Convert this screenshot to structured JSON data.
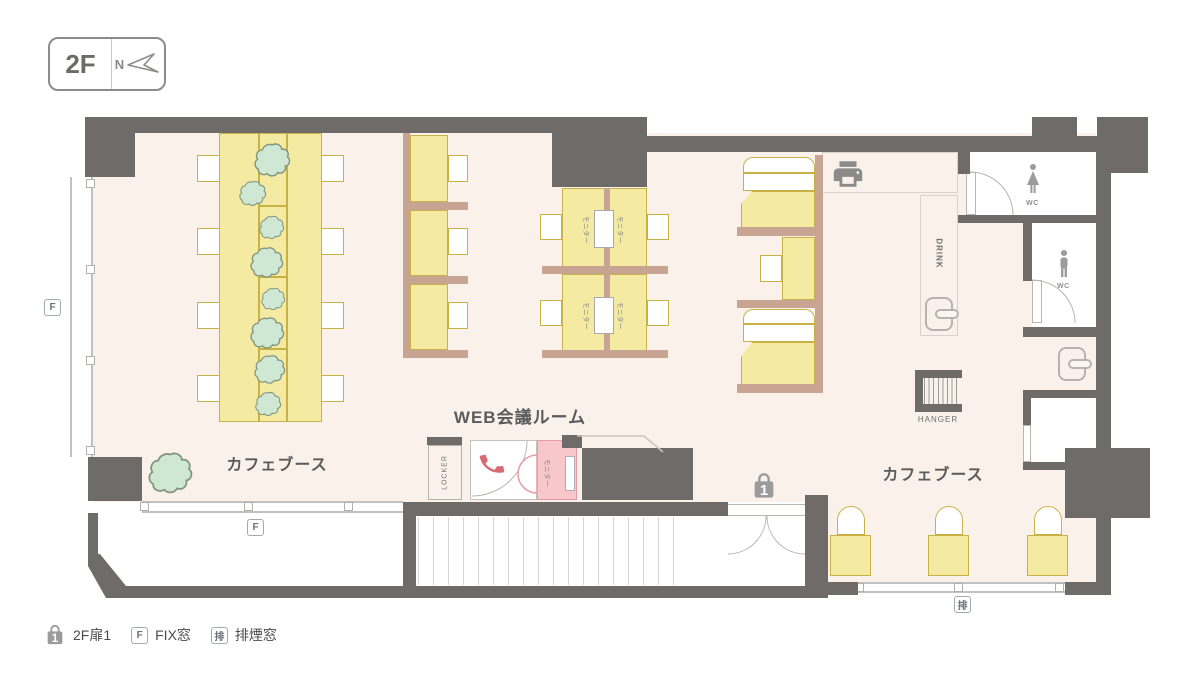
{
  "badge": {
    "floor": "2F",
    "north": "N"
  },
  "labels": {
    "cafe": "カフェブース",
    "web_meeting": "WEB会議ルーム",
    "locker": "LOCKER",
    "drink": "DRINK",
    "hanger": "HANGER",
    "monitor": "モニター",
    "wc": "WC"
  },
  "legend": {
    "door_label": "2F扉1",
    "fix_label": "FIX窓",
    "smoke_label": "排煙窓",
    "fix_badge": "F",
    "smoke_badge": "排",
    "door_number": "1"
  },
  "colors": {
    "wall": "#6e6b68",
    "floor": "#faf2ea",
    "yellow": "#f4eaa2",
    "yellowb": "#c9b245",
    "partition": "#c7a592",
    "plant": "#cfe8d3",
    "plantb": "#84947f",
    "pink": "#f8c7cb",
    "pinkb": "#ea9ba3",
    "red": "#d96a72",
    "icong": "#9b9b9b",
    "line": "#c3c1bf",
    "text": "#5b5b5d",
    "legendt": "#4b4b4b",
    "badgeb": "#8e8c8a"
  }
}
